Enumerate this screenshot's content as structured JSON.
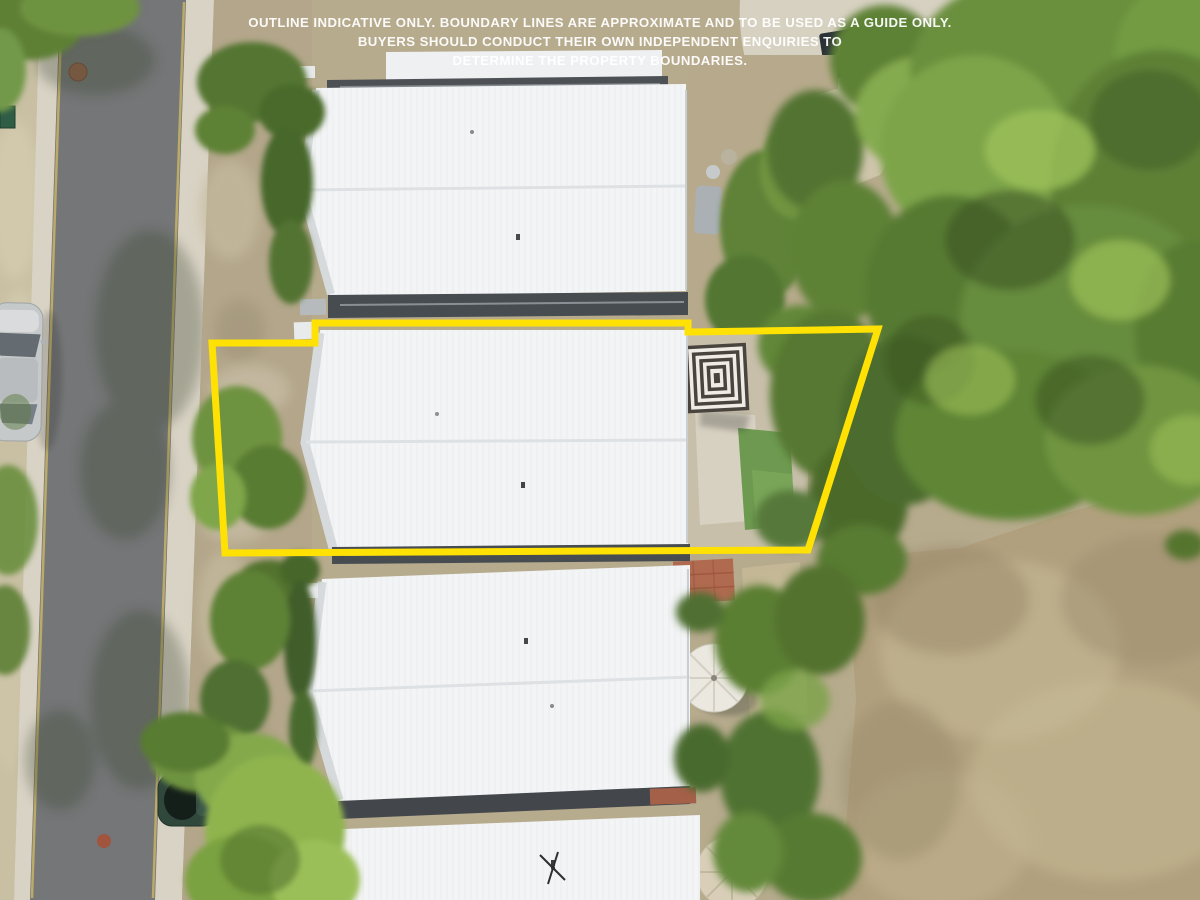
{
  "photo": {
    "kind": "aerial drone photograph (top-down)",
    "subject": "Row of white-roofed townhouses with a highlighted property outline; street with parked cars at left, rear yards, large tree canopy and dry grass paddock at right"
  },
  "disclaimer": {
    "lines": [
      "OUTLINE INDICATIVE ONLY. BOUNDARY LINES ARE APPROXIMATE AND TO BE USED AS A GUIDE ONLY.",
      "BUYERS SHOULD CONDUCT THEIR OWN INDEPENDENT ENQUIRIES TO",
      "DETERMINE THE PROPERTY BOUNDARIES."
    ],
    "text_color": "#ffffff"
  },
  "boundary_overlay": {
    "points": "315,323 688,323 688,332 878,329 808,550 225,553 212,343 315,343",
    "color": "#ffe103",
    "stroke_width": "7"
  },
  "palette": {
    "road_asphalt": "#747677",
    "curb_concrete": "#d9d3c5",
    "verge_grass": "#c9c0a4",
    "dirt": "#b3a68a",
    "roof_white": "#f3f4f6",
    "roof_gap_dark": "#474c51",
    "tree_green": "#6e9340",
    "tree_green_dark": "#4e6d2f",
    "tree_green_bright": "#8fb44e",
    "dry_grass_field": "#b1a07e",
    "lawn_turf": "#6d9a50",
    "patio_concrete": "#d7d1c2",
    "brick_patio": "#b06a50",
    "umbrella_stripe_dark": "#4a443e",
    "umbrella_white": "#efece6",
    "car_silver": "#c6c9ca",
    "car_dark_green": "#30473c",
    "gym_mat_navy": "#2b3138"
  },
  "scene_objects": [
    "street with concrete curbs and painted edge lines",
    "silver car parked at left edge",
    "dark green car parked under tree",
    "four white corrugated townhouse roofs",
    "dark gutter gaps between roofs",
    "black-and-white striped square umbrella",
    "white round umbrella",
    "tan round umbrella",
    "artificial turf lawn",
    "concrete patios and paths",
    "red brick patio",
    "dark gym mat with equipment and planter pot",
    "garden sofa and table",
    "hedges and shrubs",
    "large tree canopy",
    "dry brown grass paddock",
    "manhole covers",
    "green bin"
  ]
}
